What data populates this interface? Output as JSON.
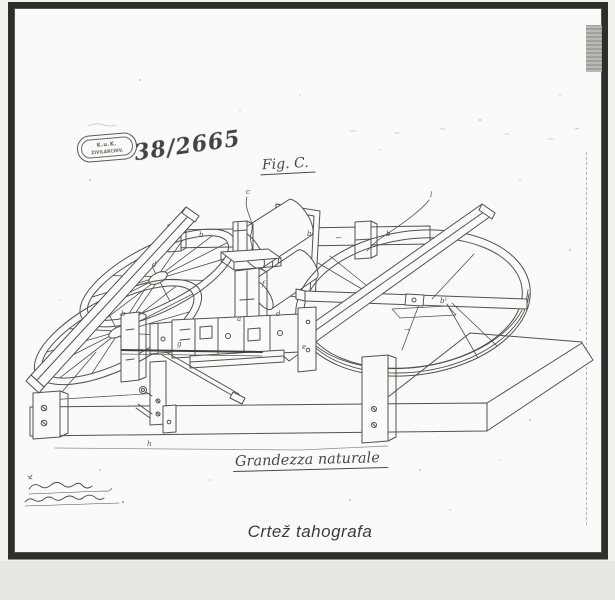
{
  "stamp": {
    "line1": "K.u.K.",
    "line2": "ZIVILARCHIV."
  },
  "annotations": {
    "archive_number": "38/2665",
    "figure_label": "Fig. C.",
    "scale_label": "Grandezza naturale",
    "caption": "Crtež tahografa"
  },
  "drawing": {
    "ink_color": "#54524d",
    "paper_color": "#fbfaf8",
    "frame_color": "#2f2e2a",
    "labels": [
      {
        "text": "c",
        "x": 246,
        "y": 188
      },
      {
        "text": "l",
        "x": 430,
        "y": 191
      },
      {
        "text": "b",
        "x": 199,
        "y": 231
      },
      {
        "text": "b",
        "x": 307,
        "y": 230
      },
      {
        "text": "b",
        "x": 386,
        "y": 230
      },
      {
        "text": "←",
        "x": 336,
        "y": 234
      },
      {
        "text": "d",
        "x": 152,
        "y": 261
      },
      {
        "text": "f",
        "x": 262,
        "y": 280
      },
      {
        "text": "b",
        "x": 121,
        "y": 310
      },
      {
        "text": "a",
        "x": 237,
        "y": 315
      },
      {
        "text": "d",
        "x": 276,
        "y": 310
      },
      {
        "text": "b¹",
        "x": 440,
        "y": 297
      },
      {
        "text": "e",
        "x": 302,
        "y": 343
      },
      {
        "text": "→",
        "x": 404,
        "y": 326
      },
      {
        "text": "g",
        "x": 177,
        "y": 340
      },
      {
        "text": "h",
        "x": 147,
        "y": 440
      }
    ]
  }
}
